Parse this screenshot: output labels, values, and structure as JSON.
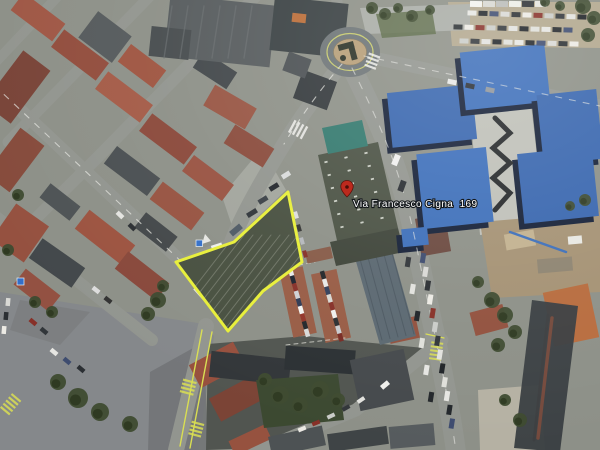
{
  "view": {
    "type": "oblique aerial satellite photo",
    "description": "Bird's-eye satellite view of an urban district with one parcel outlined in yellow"
  },
  "marker": {
    "label": "Via Francesco Cigna  169",
    "icon": "location-pin-icon",
    "pin_color": "#c5281b"
  },
  "highlight": {
    "name": "highlighted-parcel",
    "shape": "polygon",
    "outline_color": "#e9f02d"
  },
  "palette": {
    "asphalt": "#8c8f89",
    "red_roofs": "#9c5240",
    "dark_roofs": "#3c4144",
    "blue_tarp_roofs": "#3a6fc0",
    "vegetation": "#41512f",
    "roundabout_island": "#b89e74",
    "pavement_light": "#bfc0b8",
    "lane_marking_yellow": "#d9df49"
  }
}
